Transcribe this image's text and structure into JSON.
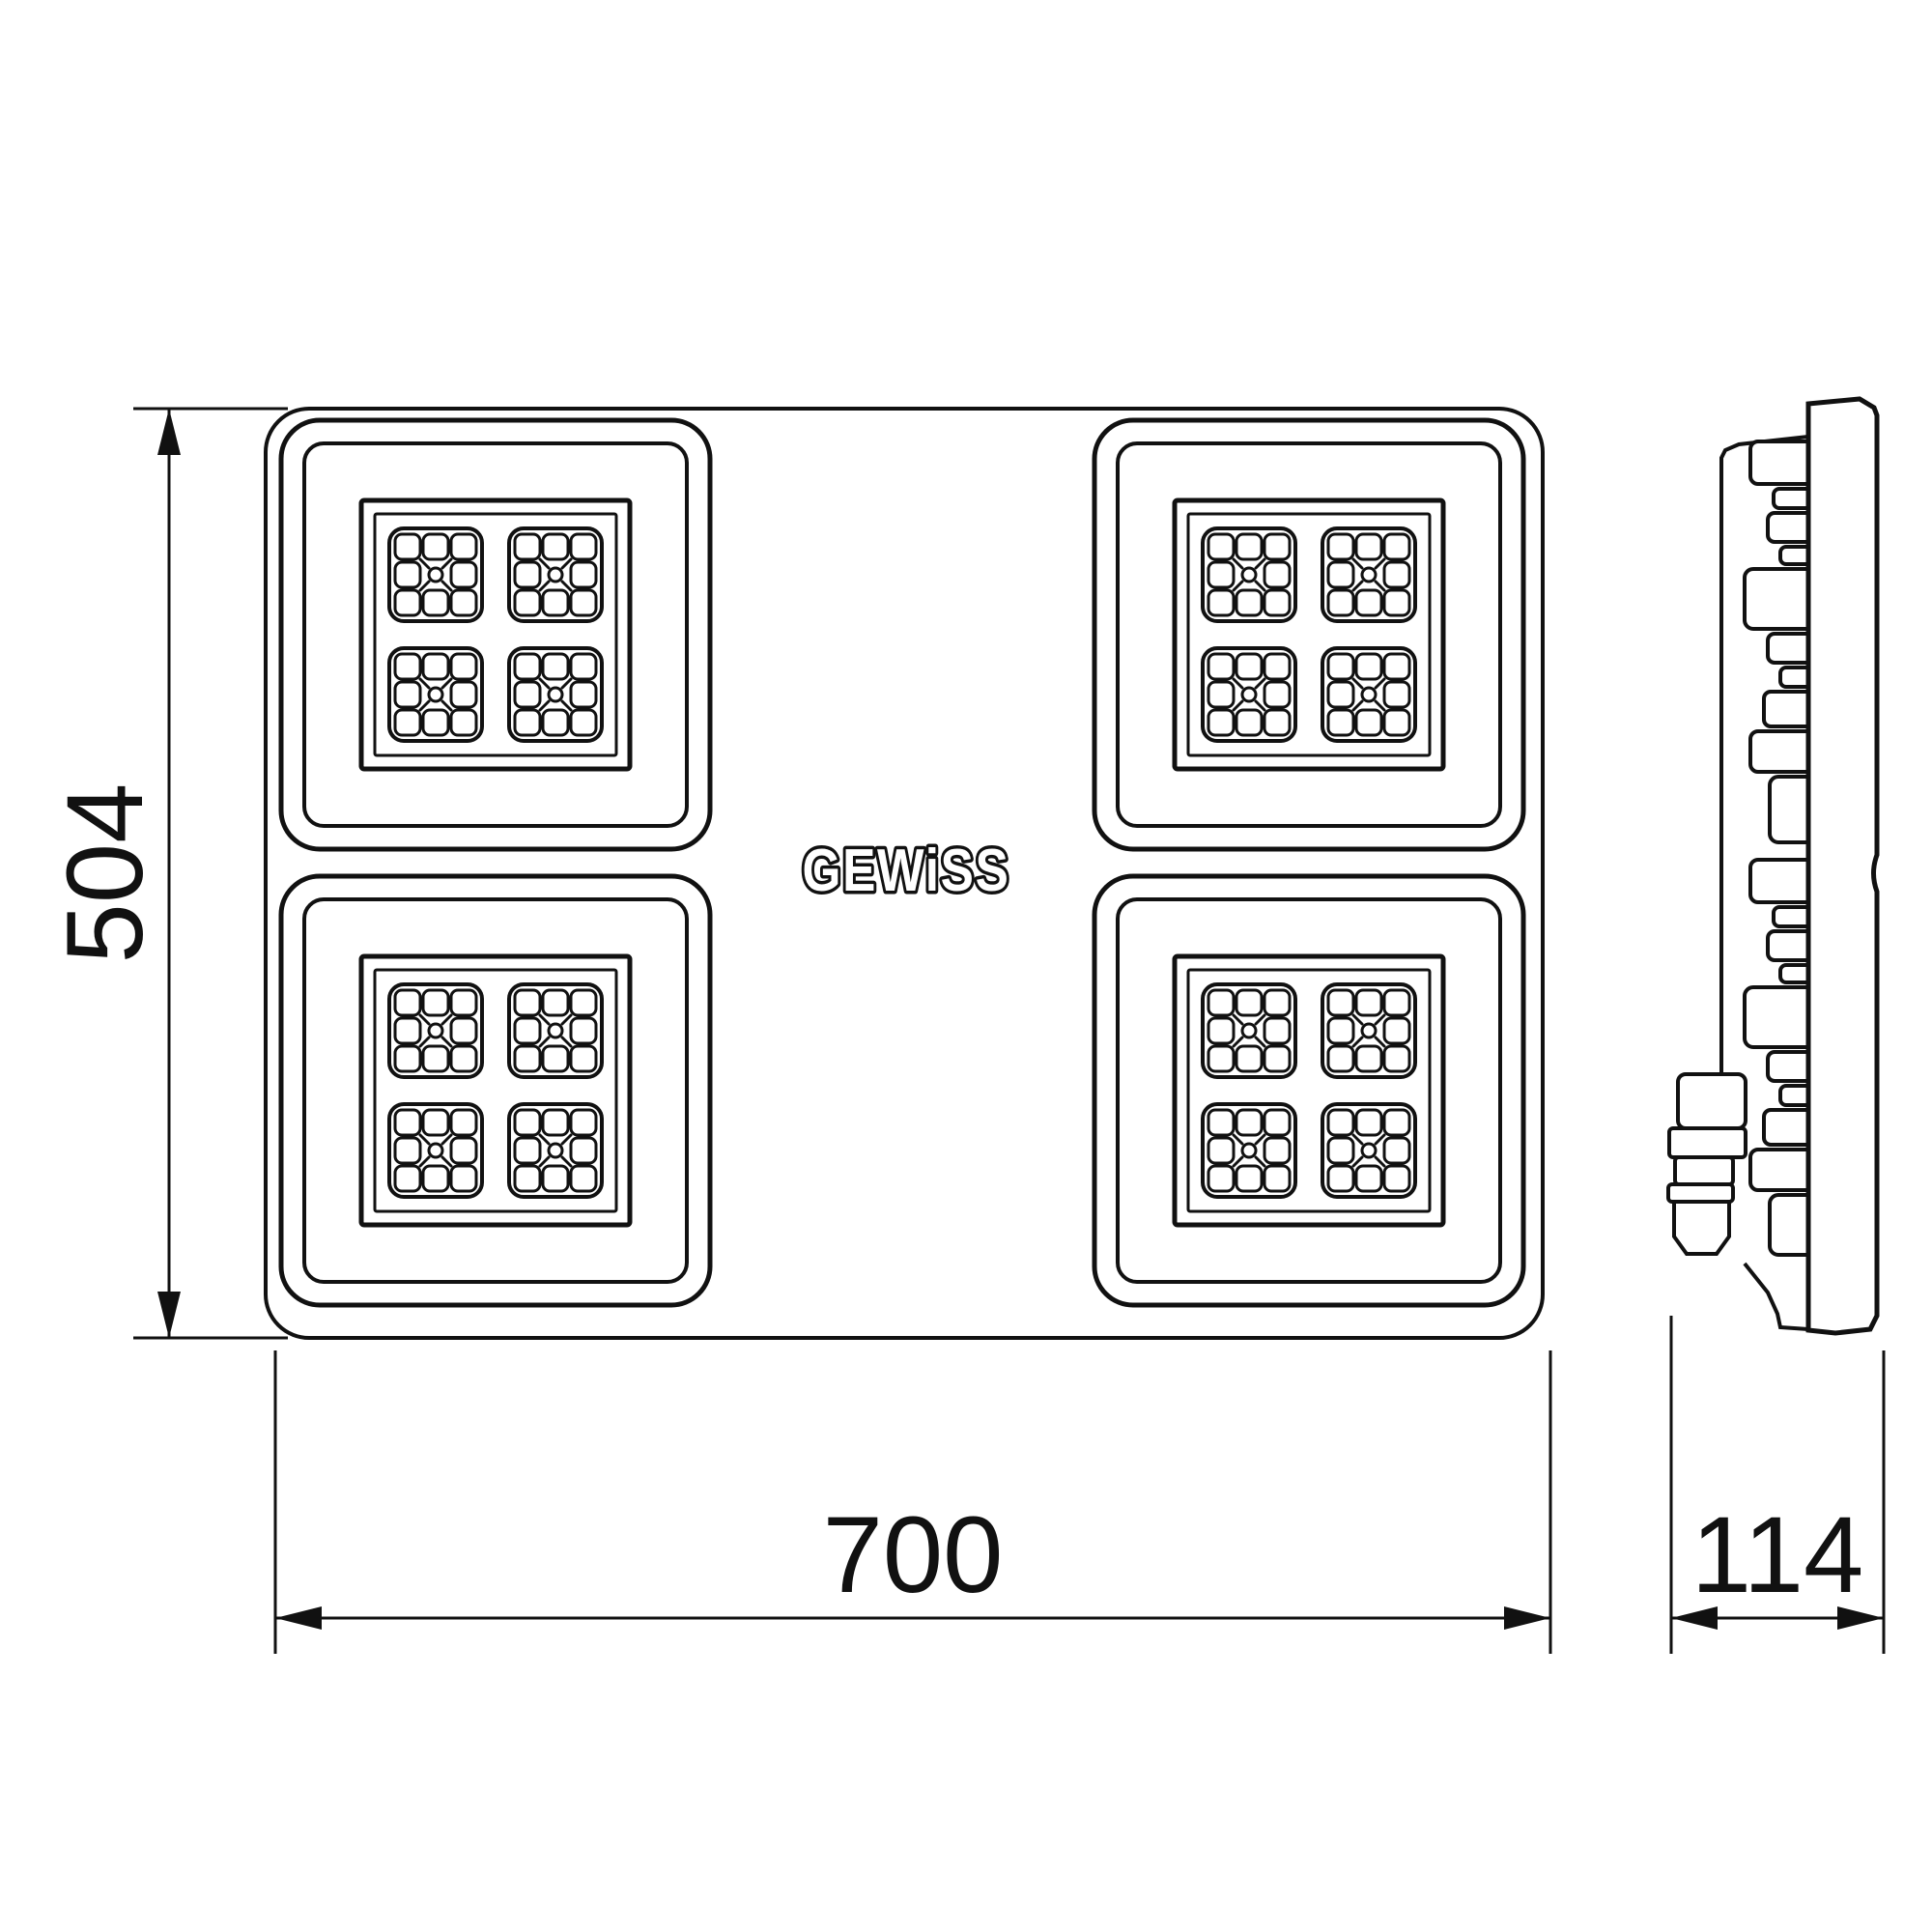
{
  "page": {
    "background": "#ffffff",
    "line_color": "#111111",
    "type": "technical-dimension-drawing"
  },
  "logo": {
    "text": "GEWiSS"
  },
  "dimensions": {
    "height": {
      "value": "504",
      "orientation": "vertical",
      "applies_to": "front-view"
    },
    "width": {
      "value": "700",
      "orientation": "horizontal",
      "applies_to": "front-view"
    },
    "depth": {
      "value": "114",
      "orientation": "horizontal",
      "applies_to": "side-view"
    }
  },
  "views": {
    "front": {
      "label": "front-view",
      "led_modules": 4,
      "clusters_per_module": 4,
      "chips_per_cluster": 9
    },
    "side": {
      "label": "side-view",
      "features": [
        "front-panel",
        "heatsink-fins",
        "cable-gland"
      ]
    }
  }
}
